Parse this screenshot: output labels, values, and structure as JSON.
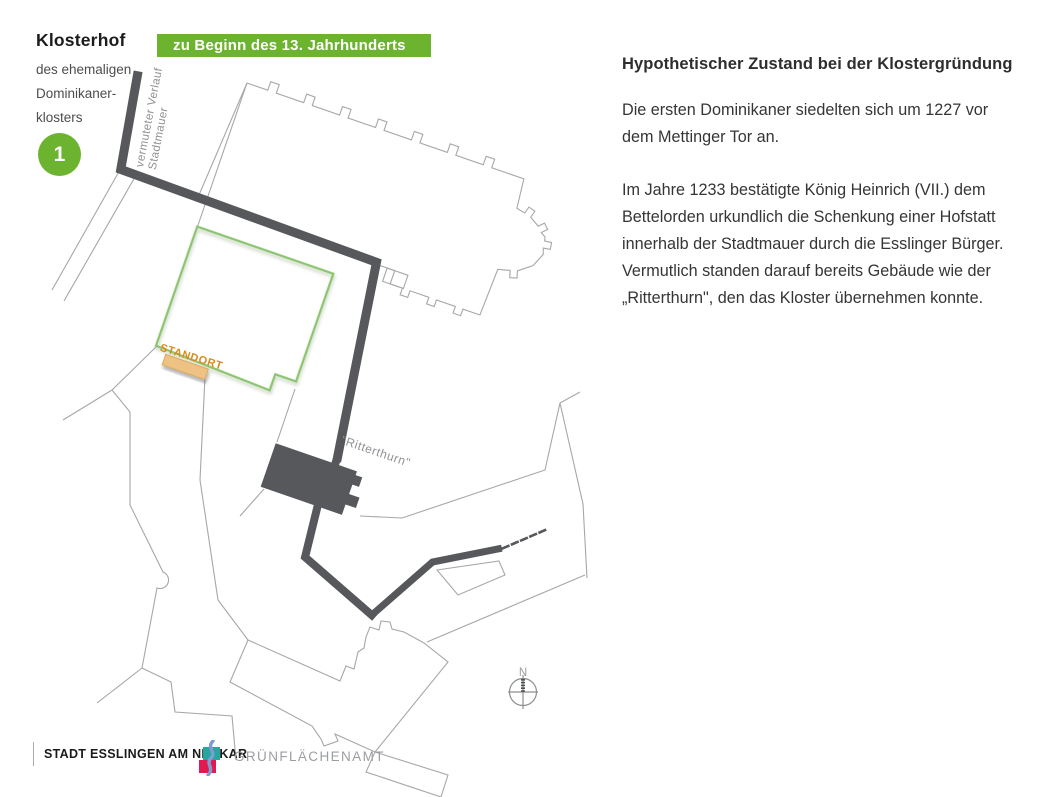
{
  "header": {
    "title": "Klosterhof",
    "subtitle_lines": [
      "des ehemaligen",
      "Dominikaner-",
      "klosters"
    ],
    "badge_number": "1",
    "banner": "zu Beginn des 13. Jahrhunderts"
  },
  "map": {
    "labels": {
      "wall_lines": [
        "vermuteter Verlauf",
        "Stadtmauer"
      ],
      "location": "STANDORT",
      "tower": "\"Ritterthurn\"",
      "compass_north": "N"
    }
  },
  "article": {
    "heading": "Hypothetischer Zustand bei der Klostergründung",
    "paragraphs": [
      [
        "Die ersten Dominikaner siedelten sich um 1227 vor",
        "dem Mettinger Tor an."
      ],
      [
        "Im Jahre 1233 bestätigte König Heinrich (VII.) dem",
        "Bettelorden urkundlich die Schenkung einer Hofstatt",
        "innerhalb der Stadtmauer durch die Esslinger Bürger.",
        " Vermutlich standen darauf bereits Gebäude wie der",
        "„Ritterthurn\", den das Kloster übernehmen konnte."
      ]
    ]
  },
  "footer": {
    "org": "STADT ESSLINGEN AM NECKAR",
    "dept": "GRÜNFLÄCHENAMT"
  },
  "colors": {
    "accent_green": "#6cb32f",
    "wall_gray": "#57585b",
    "outline_gray": "#a5a7aa",
    "label_gray": "#8f9194",
    "standort_orange": "#d98a19",
    "marker_fill": "#eec184",
    "courtyard_green": "#8cc46f",
    "logo_teal": "#23a79f",
    "logo_red": "#e31a50",
    "logo_blue": "#7d9ed2"
  }
}
